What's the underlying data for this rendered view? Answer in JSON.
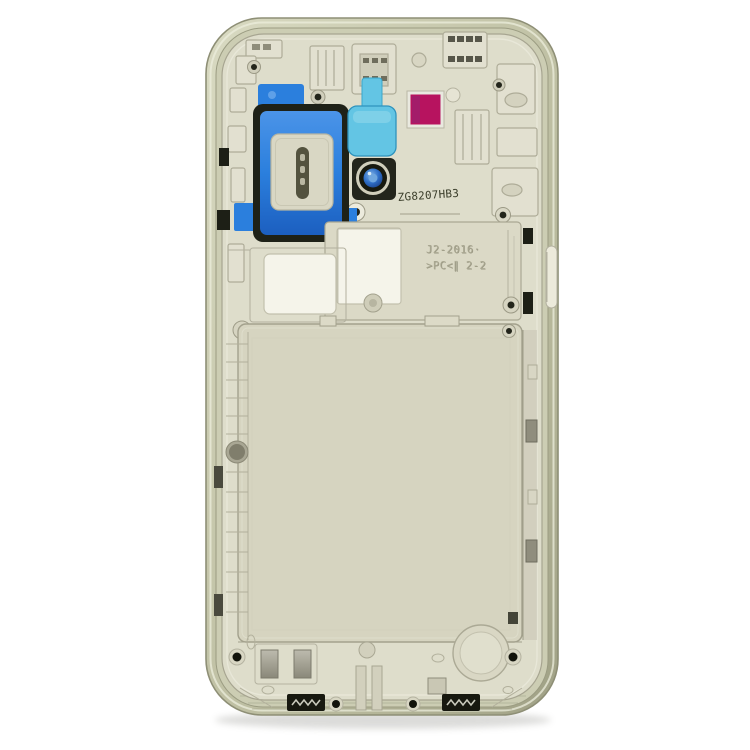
{
  "meta": {
    "title": "Product photo: smartphone back mid-frame housing on white background"
  },
  "object": {
    "kind": "phone-midframe-back-housing",
    "etched_serial": "ZG8207HB3",
    "mold_text_line1": "J2-2016·",
    "mold_text_line2": ">PC<∥ 2-2"
  },
  "colors": {
    "background": "#ffffff",
    "rim_champagne": "#c8c9ad",
    "plastic_beige": "#deddcb",
    "battery_bay": "#d6d4c0",
    "gasket_black": "#1e2117",
    "adhesive_blue": "#2b7fdd",
    "adhesive_light_blue": "#63c5e4",
    "sticker_magenta": "#b7135f",
    "camera_iris_blue": "#2f6fc8",
    "etched_text": "#3a3d2a",
    "mold_text": "#a9a791"
  }
}
